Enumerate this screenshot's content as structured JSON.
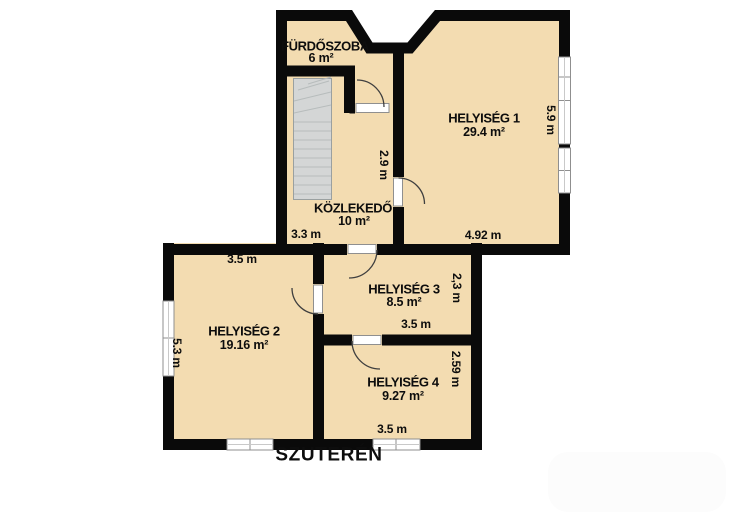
{
  "plan": {
    "title": "SZUTERÉN",
    "rooms": [
      {
        "name": "FÜRDŐSZOBA",
        "area": "6 m²"
      },
      {
        "name": "HELYISÉG 1",
        "area": "29.4 m²"
      },
      {
        "name": "KÖZLEKEDŐ",
        "area": "10 m²"
      },
      {
        "name": "HELYISÉG 2",
        "area": "19.16 m²"
      },
      {
        "name": "HELYISÉG 3",
        "area": "8.5 m²"
      },
      {
        "name": "HELYISÉG 4",
        "area": "9.27 m²"
      }
    ],
    "dimensions": [
      {
        "label": "3.3 m"
      },
      {
        "label": "4.92 m"
      },
      {
        "label": "5.9 m"
      },
      {
        "label": "2.9 m"
      },
      {
        "label": "3.5 m"
      },
      {
        "label": "2,3 m"
      },
      {
        "label": "3.5 m"
      },
      {
        "label": "2.59 m"
      },
      {
        "label": "3.5 m"
      },
      {
        "label": "5.3 m"
      }
    ],
    "colors": {
      "floor": "#F3DCB1",
      "wall": "#0A0A0A",
      "stairs": "#D4D6D6",
      "stair_lines": "#B7BCBC",
      "window": "#FFFFFF",
      "window_frame": "#8F8F8F",
      "door_arc": "#3F3F3F",
      "text": "#0D0D0D"
    }
  }
}
